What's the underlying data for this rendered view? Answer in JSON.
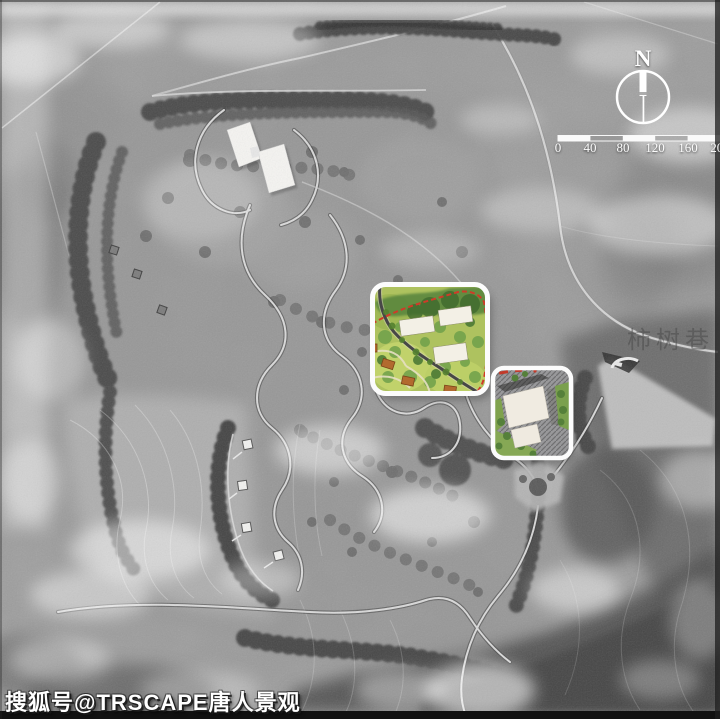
{
  "compass": {
    "north_label": "N"
  },
  "scalebar": {
    "ticks": [
      "0",
      "40",
      "80",
      "120",
      "160",
      "200"
    ],
    "segment_meters": 40
  },
  "labels": {
    "place_faint": "柿树巷"
  },
  "watermark": {
    "text": "搜狐号@TRSCAPE唐人景观"
  },
  "insets": [
    {
      "name": "landscape-detail-plan"
    },
    {
      "name": "building-detail-plan"
    }
  ],
  "colors": {
    "photo_gray": "#9b9b9b",
    "forest_dark": "#4e4e4e",
    "meadow_light": "#b4b4b4",
    "road_light": "#e0e0e0",
    "building_white": "#f6f5f2",
    "inset_green_base": "#aec25f",
    "inset_green_dark": "#4c7a35",
    "boundary_red": "#cf3b28",
    "structure_orange": "#b26a2f",
    "frame_black": "#111111"
  }
}
